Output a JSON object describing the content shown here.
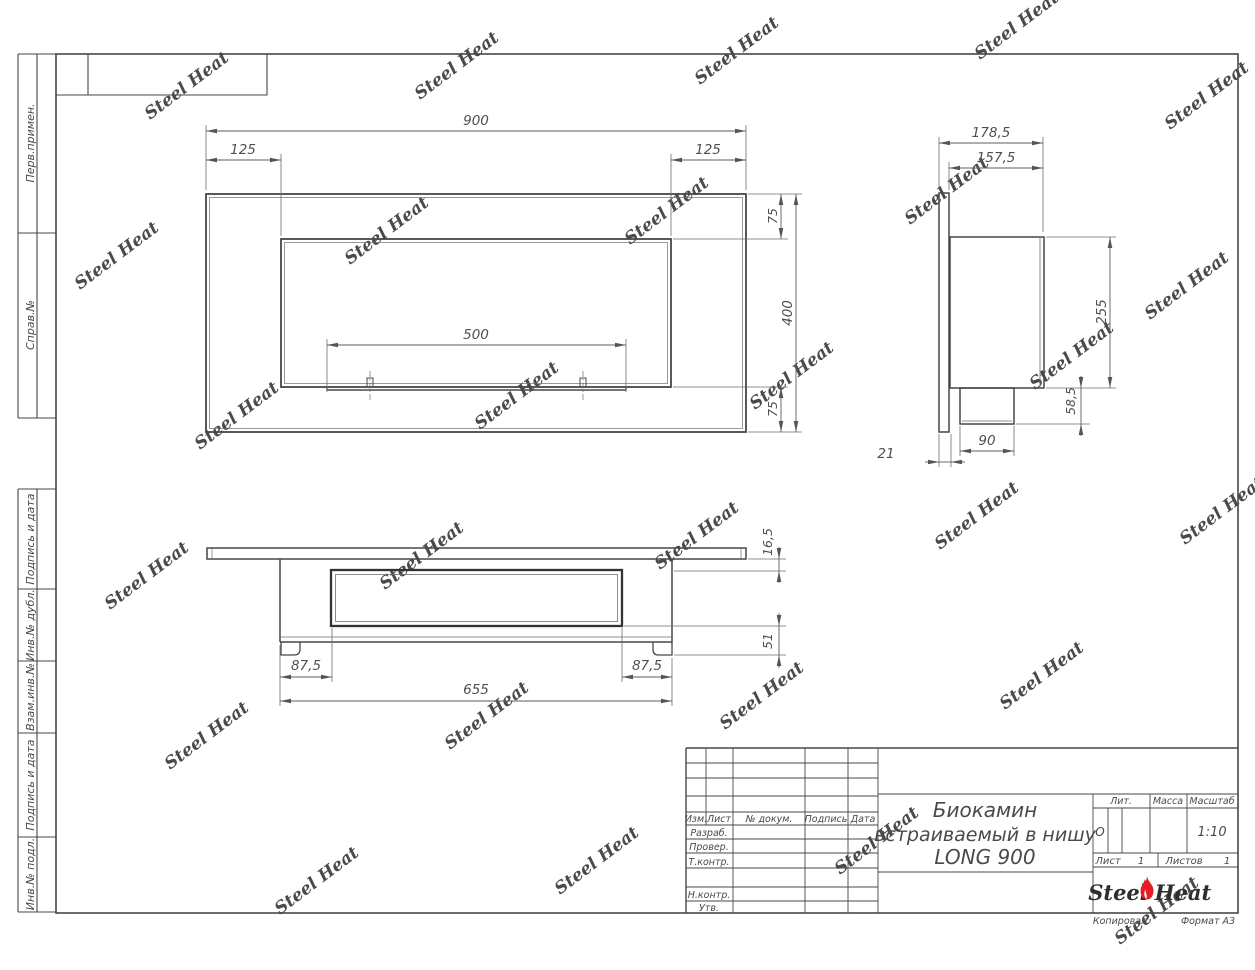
{
  "sheet": {
    "copied_label": "Копировал",
    "format_label": "Формат А3"
  },
  "frame": {
    "left_strip": [
      "Перв.примен.",
      "Справ.№",
      "Подпись и дата",
      "Инв.№ дубл.",
      "Взам.инв.№",
      "Подпись и дата",
      "Инв.№ подл."
    ]
  },
  "views": {
    "front": {
      "dims": {
        "width": "900",
        "left_offset": "125",
        "right_offset": "125",
        "burner_length": "500",
        "top_frame": "75",
        "height": "400",
        "bottom_frame": "75"
      }
    },
    "side": {
      "dims": {
        "depth_total": "178,5",
        "depth_body": "157,5",
        "body_height": "255",
        "tray_height": "58,5",
        "tray_depth": "90",
        "panel_thickness": "21"
      }
    },
    "top": {
      "dims": {
        "panel_thickness": "16,5",
        "left_inset": "87,5",
        "right_inset": "87,5",
        "body_length": "655",
        "inner_depth": "51"
      }
    }
  },
  "title_block": {
    "header_cols": [
      "Изм.",
      "Лист",
      "№ докум.",
      "Подпись",
      "Дата"
    ],
    "role_rows": [
      "Разраб.",
      "Провер.",
      "Т.контр.",
      "Н.контр.",
      "Утв."
    ],
    "title_lines": [
      "Биокамин",
      "встраиваемый в нишу",
      "LONG 900"
    ],
    "lit_label": "Лит.",
    "lit_value": "О",
    "mass_label": "Масса",
    "scale_label": "Масштаб",
    "scale_value": "1:10",
    "sheet_label": "Лист",
    "sheet_value": "1",
    "sheets_label": "Листов",
    "sheets_value": "1",
    "brand": {
      "steel": "Steel",
      "heat": "Heat"
    }
  },
  "watermark": {
    "text": "Steel Heat"
  }
}
